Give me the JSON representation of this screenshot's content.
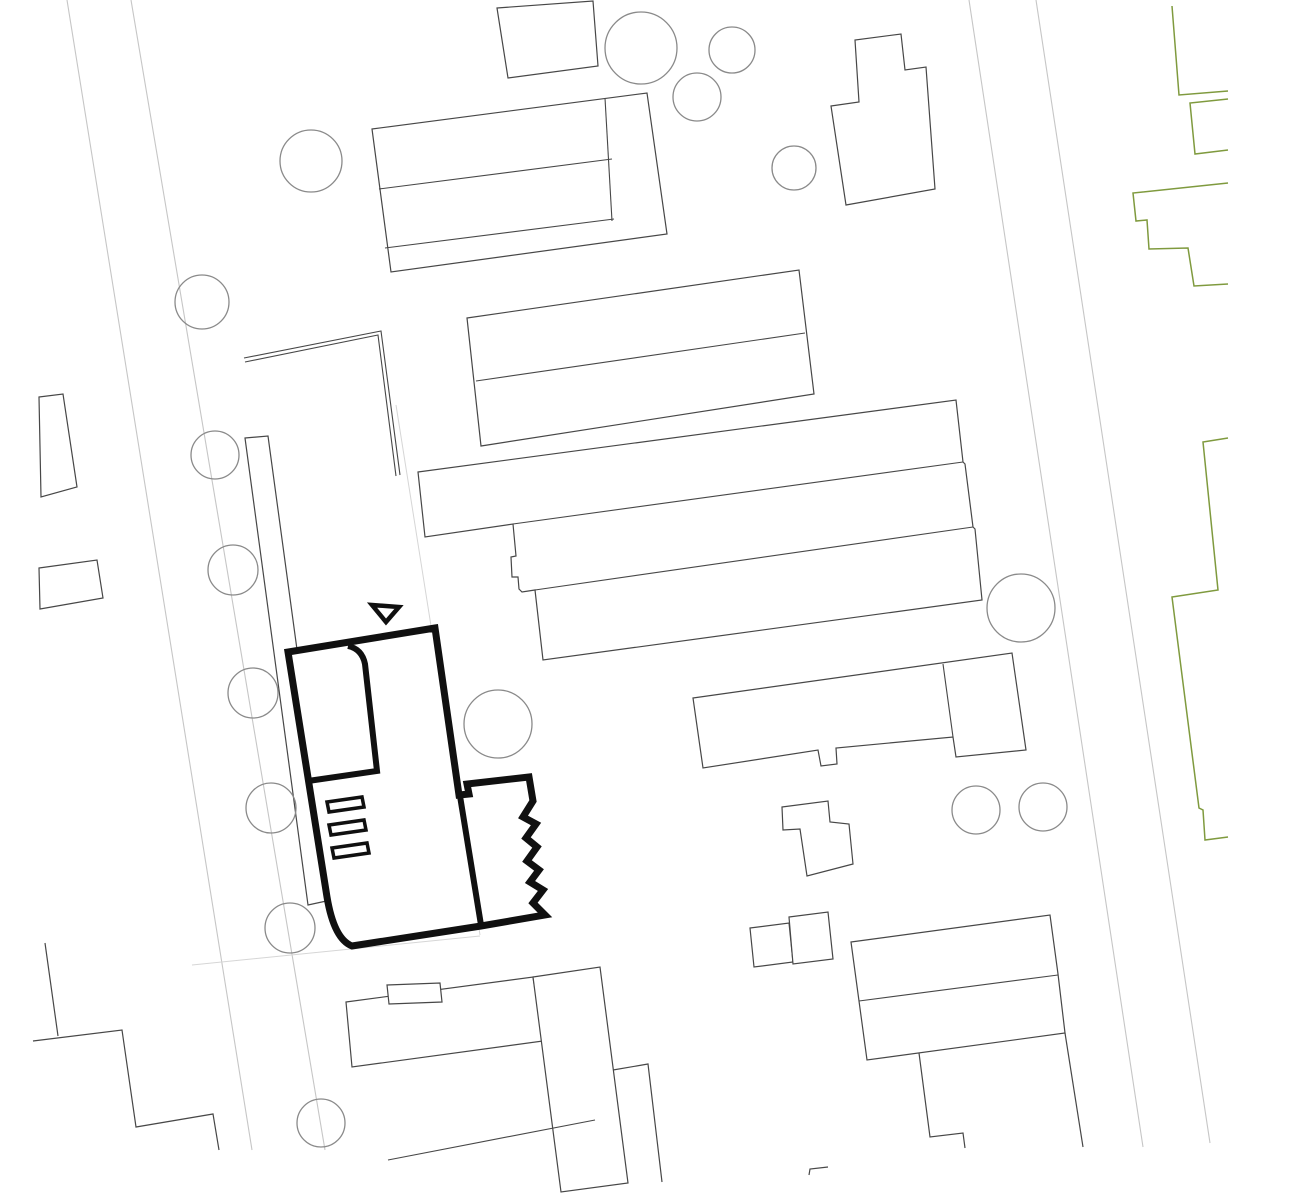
{
  "drawing": {
    "width": 1297,
    "height": 1200,
    "palette": {
      "paper": "#ffffff",
      "building": "#474747",
      "tree": "#8a8a8a",
      "street": "#c6c6c6",
      "parcel": "#d6d6d6",
      "greenery": "#7f9a3e",
      "highlight": "#101010"
    },
    "layers": [
      {
        "name": "streets",
        "shapes": [
          {
            "name": "street-edge-left-outer",
            "type": "polyline",
            "points": "67,0 252,1150",
            "stroke": "street",
            "width": 1.1,
            "fill": "none"
          },
          {
            "name": "street-edge-left-inner",
            "type": "polyline",
            "points": "131,0 325,1150",
            "stroke": "street",
            "width": 1.1,
            "fill": "none"
          },
          {
            "name": "street-edge-right-inner",
            "type": "polyline",
            "points": "969,0 1143,1147",
            "stroke": "street",
            "width": 1.1,
            "fill": "none"
          },
          {
            "name": "street-edge-right-outer",
            "type": "polyline",
            "points": "1036,0 1210,1143",
            "stroke": "street",
            "width": 1.1,
            "fill": "none"
          },
          {
            "name": "parcel-boundary-east",
            "type": "polyline",
            "points": "396,405 480,935",
            "stroke": "parcel",
            "width": 1,
            "fill": "none"
          },
          {
            "name": "parcel-boundary-south",
            "type": "polyline",
            "points": "192,965 480,936",
            "stroke": "parcel",
            "width": 1,
            "fill": "none"
          }
        ]
      },
      {
        "name": "greenery-boundaries",
        "shapes": [
          {
            "name": "green-boundary-segment-1",
            "type": "polyline",
            "points": "1172,6 1179,95 1228,91",
            "stroke": "greenery",
            "width": 1.5,
            "fill": "none"
          },
          {
            "name": "green-boundary-segment-2",
            "type": "polyline",
            "points": "1228,99 1190,103 1195,154 1228,150",
            "stroke": "greenery",
            "width": 1.5,
            "fill": "none"
          },
          {
            "name": "green-boundary-segment-3",
            "type": "polyline",
            "points": "1228,183 1133,193 1136,221 1147,220 1149,249 1188,248 1194,286 1228,284",
            "stroke": "greenery",
            "width": 1.5,
            "fill": "none"
          },
          {
            "name": "green-boundary-segment-4",
            "type": "polyline",
            "points": "1228,438 1203,442 1218,590 1172,597 1199,808 1203,810 1205,840 1228,837",
            "stroke": "greenery",
            "width": 1.5,
            "fill": "none"
          }
        ]
      },
      {
        "name": "context-buildings",
        "shapes": [
          {
            "name": "building-top-edge-small",
            "type": "polygon",
            "points": "497,8 593,1 598,66 508,78",
            "stroke": "building",
            "width": 1.2,
            "fill": "paper"
          },
          {
            "name": "building-north-long-block",
            "type": "polygon",
            "points": "372,129 647,93 667,234 391,272",
            "stroke": "building",
            "width": 1.2,
            "fill": "paper"
          },
          {
            "name": "building-north-long-block-divider-1",
            "type": "polyline",
            "points": "379,189 612,159",
            "stroke": "building",
            "width": 1.1,
            "fill": "none"
          },
          {
            "name": "building-north-long-block-divider-2",
            "type": "polyline",
            "points": "385,248 614,219",
            "stroke": "building",
            "width": 1.1,
            "fill": "none"
          },
          {
            "name": "building-north-long-block-cross-line",
            "type": "polyline",
            "points": "605,98 612,221",
            "stroke": "building",
            "width": 1.1,
            "fill": "none"
          },
          {
            "name": "building-northeast-stepped",
            "type": "polygon",
            "points": "831,106 859,102 855,40 901,34 905,70 926,67 935,189 846,205",
            "stroke": "building",
            "width": 1.2,
            "fill": "paper"
          },
          {
            "name": "building-center-bar-pair",
            "type": "polygon",
            "points": "467,318 799,270 814,394 481,446",
            "stroke": "building",
            "width": 1.2,
            "fill": "paper"
          },
          {
            "name": "building-center-bar-pair-divider",
            "type": "polyline",
            "points": "476,381 805,333",
            "stroke": "building",
            "width": 1.1,
            "fill": "none"
          },
          {
            "name": "garden-wall-line-1",
            "type": "polyline",
            "points": "244,358 381,331 400,475",
            "stroke": "building",
            "width": 1.1,
            "fill": "none"
          },
          {
            "name": "garden-wall-line-2",
            "type": "polyline",
            "points": "245,362 378,335 396,476",
            "stroke": "building",
            "width": 1.1,
            "fill": "none"
          },
          {
            "name": "narrow-strip-building",
            "type": "polygon",
            "points": "245,438 268,436 331,900 308,905",
            "stroke": "building",
            "width": 1.2,
            "fill": "paper"
          },
          {
            "name": "building-large-terrace-block",
            "type": "polygon",
            "points": "418,472 956,400 963,462 965,464 973,527 975,529 982,600 543,660 535,590 522,592 519,589 518,577 512,577 511,557 516,556 513,524 425,537",
            "stroke": "building",
            "width": 1.2,
            "fill": "paper"
          },
          {
            "name": "building-large-terrace-divider-1",
            "type": "polyline",
            "points": "513,524 963,462",
            "stroke": "building",
            "width": 1.1,
            "fill": "none"
          },
          {
            "name": "building-large-terrace-divider-2",
            "type": "polyline",
            "points": "535,590 973,527",
            "stroke": "building",
            "width": 1.1,
            "fill": "none"
          },
          {
            "name": "building-east-bar-with-tower",
            "type": "polygon",
            "points": "693,698 1012,653 1026,750 956,757 953,737 836,748 837,764 821,766 818,750 703,768",
            "stroke": "building",
            "width": 1.2,
            "fill": "paper"
          },
          {
            "name": "building-east-bar-tower-edge",
            "type": "polyline",
            "points": "943,664 953,737",
            "stroke": "building",
            "width": 1.1,
            "fill": "none"
          },
          {
            "name": "building-small-l-shape",
            "type": "polygon",
            "points": "782,807 828,801 830,822 849,824 853,864 807,876 800,829 783,830",
            "stroke": "building",
            "width": 1.2,
            "fill": "paper"
          },
          {
            "name": "building-south-bar",
            "type": "polygon",
            "points": "346,1002 533,977 543,1041 352,1067",
            "stroke": "building",
            "width": 1.2,
            "fill": "paper"
          },
          {
            "name": "building-south-bar-attachment",
            "type": "polygon",
            "points": "387,985 440,983 442,1002 389,1004",
            "stroke": "building",
            "width": 1.2,
            "fill": "paper"
          },
          {
            "name": "building-south-tall-slab",
            "type": "polygon",
            "points": "533,977 600,967 628,1183 561,1192",
            "stroke": "building",
            "width": 1.2,
            "fill": "paper"
          },
          {
            "name": "building-south-tall-slab-wing",
            "type": "polyline",
            "points": "613,1070 648,1064 662,1182",
            "stroke": "building",
            "width": 1.2,
            "fill": "none"
          },
          {
            "name": "building-twin-square-west",
            "type": "polygon",
            "points": "750,928 789,923 793,962 754,967",
            "stroke": "building",
            "width": 1.2,
            "fill": "paper"
          },
          {
            "name": "building-twin-square-east",
            "type": "polygon",
            "points": "789,917 828,912 833,959 793,964",
            "stroke": "building",
            "width": 1.2,
            "fill": "paper"
          },
          {
            "name": "building-southeast-slab",
            "type": "polygon",
            "points": "851,942 1050,915 1058,974 1065,1033 867,1060",
            "stroke": "building",
            "width": 1.2,
            "fill": "paper"
          },
          {
            "name": "building-southeast-slab-divider",
            "type": "polyline",
            "points": "859,1001 1058,975",
            "stroke": "building",
            "width": 1.1,
            "fill": "none"
          },
          {
            "name": "building-southeast-lower-step",
            "type": "polyline",
            "points": "919,1053 930,1137 963,1133 965,1148",
            "stroke": "building",
            "width": 1.2,
            "fill": "none"
          },
          {
            "name": "building-southeast-lower-edge",
            "type": "polyline",
            "points": "1065,1033 1083,1147",
            "stroke": "building",
            "width": 1.2,
            "fill": "none"
          },
          {
            "name": "building-southwest-step-1",
            "type": "polyline",
            "points": "45,943 58,1036",
            "stroke": "building",
            "width": 1.2,
            "fill": "none"
          },
          {
            "name": "building-southwest-step-2",
            "type": "polyline",
            "points": "33,1041 122,1030 136,1127 213,1114 219,1150",
            "stroke": "building",
            "width": 1.2,
            "fill": "none"
          },
          {
            "name": "building-west-small-upper",
            "type": "polygon",
            "points": "39,397 63,394 77,487 41,497",
            "stroke": "building",
            "width": 1.2,
            "fill": "paper"
          },
          {
            "name": "building-west-small-lower",
            "type": "polygon",
            "points": "39,568 97,560 103,598 40,609",
            "stroke": "building",
            "width": 1.2,
            "fill": "paper"
          },
          {
            "name": "path-wedge-line",
            "type": "polyline",
            "points": "388,1160 595,1120",
            "stroke": "building",
            "width": 1.1,
            "fill": "none"
          },
          {
            "name": "small-mark-south",
            "type": "polyline",
            "points": "809,1175 810,1169 828,1167",
            "stroke": "building",
            "width": 1.2,
            "fill": "none"
          }
        ]
      },
      {
        "name": "trees",
        "shapes": [
          {
            "name": "tree",
            "type": "circle",
            "cx": 311,
            "cy": 161,
            "r": 31,
            "stroke": "tree",
            "width": 1.3,
            "fill": "none"
          },
          {
            "name": "tree",
            "type": "circle",
            "cx": 202,
            "cy": 302,
            "r": 27,
            "stroke": "tree",
            "width": 1.3,
            "fill": "none"
          },
          {
            "name": "tree",
            "type": "circle",
            "cx": 641,
            "cy": 48,
            "r": 36,
            "stroke": "tree",
            "width": 1.3,
            "fill": "none"
          },
          {
            "name": "tree",
            "type": "circle",
            "cx": 732,
            "cy": 50,
            "r": 23,
            "stroke": "tree",
            "width": 1.3,
            "fill": "none"
          },
          {
            "name": "tree",
            "type": "circle",
            "cx": 697,
            "cy": 97,
            "r": 24,
            "stroke": "tree",
            "width": 1.3,
            "fill": "none"
          },
          {
            "name": "tree",
            "type": "circle",
            "cx": 794,
            "cy": 168,
            "r": 22,
            "stroke": "tree",
            "width": 1.3,
            "fill": "none"
          },
          {
            "name": "tree",
            "type": "circle",
            "cx": 215,
            "cy": 455,
            "r": 24,
            "stroke": "tree",
            "width": 1.3,
            "fill": "none"
          },
          {
            "name": "tree",
            "type": "circle",
            "cx": 233,
            "cy": 570,
            "r": 25,
            "stroke": "tree",
            "width": 1.3,
            "fill": "none"
          },
          {
            "name": "tree",
            "type": "circle",
            "cx": 253,
            "cy": 693,
            "r": 25,
            "stroke": "tree",
            "width": 1.3,
            "fill": "none"
          },
          {
            "name": "tree",
            "type": "circle",
            "cx": 271,
            "cy": 808,
            "r": 25,
            "stroke": "tree",
            "width": 1.3,
            "fill": "none"
          },
          {
            "name": "tree",
            "type": "circle",
            "cx": 290,
            "cy": 928,
            "r": 25,
            "stroke": "tree",
            "width": 1.3,
            "fill": "none"
          },
          {
            "name": "tree",
            "type": "circle",
            "cx": 321,
            "cy": 1123,
            "r": 24,
            "stroke": "tree",
            "width": 1.3,
            "fill": "none"
          },
          {
            "name": "tree",
            "type": "circle",
            "cx": 498,
            "cy": 724,
            "r": 34,
            "stroke": "tree",
            "width": 1.3,
            "fill": "none"
          },
          {
            "name": "tree",
            "type": "circle",
            "cx": 1021,
            "cy": 608,
            "r": 34,
            "stroke": "tree",
            "width": 1.3,
            "fill": "none"
          },
          {
            "name": "tree",
            "type": "circle",
            "cx": 976,
            "cy": 810,
            "r": 24,
            "stroke": "tree",
            "width": 1.3,
            "fill": "none"
          },
          {
            "name": "tree",
            "type": "circle",
            "cx": 1043,
            "cy": 807,
            "r": 24,
            "stroke": "tree",
            "width": 1.3,
            "fill": "none"
          }
        ]
      },
      {
        "name": "main-building",
        "shapes": [
          {
            "name": "main-building-outline",
            "type": "path",
            "d": "M435,628 L288,652 L327,897 Q334,939 352,946 L481,926 L545,915 L533,903 L543,890 L530,882 L539,870 L527,861 L537,847 L526,838 L536,824 L523,817 L533,801 L529,777 L467,784 L469,794 L459,795 Z",
            "stroke": "highlight",
            "width": 7,
            "fill": "paper"
          },
          {
            "name": "main-building-left-wing",
            "type": "path",
            "d": "M348,646 Q362,649 365,664 L377,771 L308,781",
            "stroke": "highlight",
            "width": 6,
            "fill": "none"
          },
          {
            "name": "main-building-annex-divider",
            "type": "path",
            "d": "M460,796 L481,925",
            "stroke": "highlight",
            "width": 6,
            "fill": "none"
          },
          {
            "name": "entrance-arrow",
            "type": "path",
            "d": "M372,605 L399,607 L386,622 Z",
            "stroke": "highlight",
            "width": 4.5,
            "fill": "paper"
          },
          {
            "name": "stair-bar-1",
            "type": "polygon",
            "points": "327,802 362,797 364,807 329,812",
            "stroke": "highlight",
            "width": 3.5,
            "fill": "paper"
          },
          {
            "name": "stair-bar-2",
            "type": "polygon",
            "points": "329,825 364,820 366,830 331,835",
            "stroke": "highlight",
            "width": 3.5,
            "fill": "paper"
          },
          {
            "name": "stair-bar-3",
            "type": "polygon",
            "points": "332,848 367,843 369,853 334,858",
            "stroke": "highlight",
            "width": 3.5,
            "fill": "paper"
          }
        ]
      }
    ]
  }
}
